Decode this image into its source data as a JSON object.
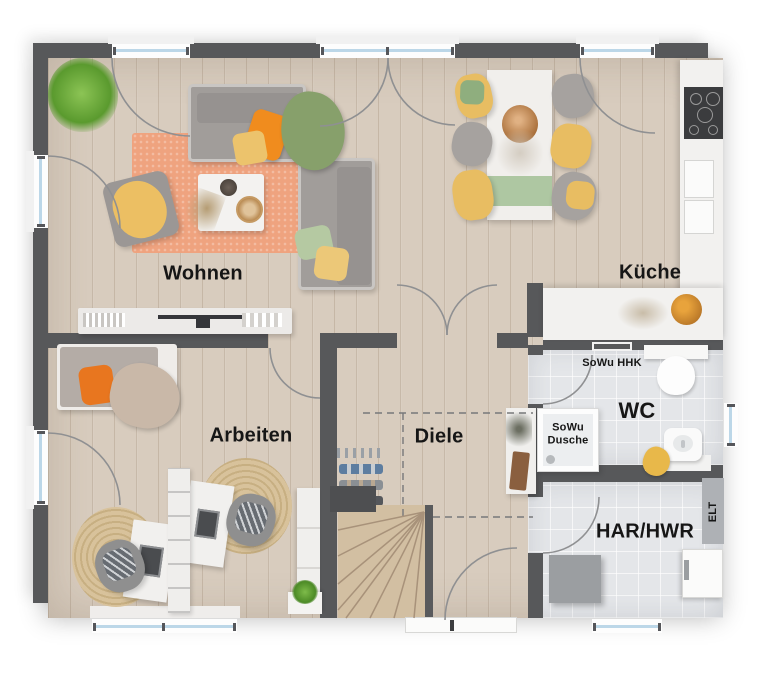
{
  "plan": {
    "labels": {
      "wohnen": "Wohnen",
      "kueche": "Küche",
      "arbeiten": "Arbeiten",
      "diele": "Diele",
      "wc": "WC",
      "har_hwr": "HAR/HWR",
      "sowu_hhk": "SoWu HHK",
      "sowu_dusche_line1": "SoWu",
      "sowu_dusche_line2": "Dusche",
      "elt": "ELT"
    },
    "colors": {
      "wall": "#57585a",
      "wood_floor": "#d8ccbe",
      "tile_floor": "#e2e4e7",
      "rug": "#efa37f",
      "accent_orange": "#f08c1e",
      "accent_yellow": "#ecc36c",
      "accent_green": "#8aa06b",
      "window_glass": "#bcd7e8",
      "stair_wood": "#d2bfa2"
    }
  }
}
